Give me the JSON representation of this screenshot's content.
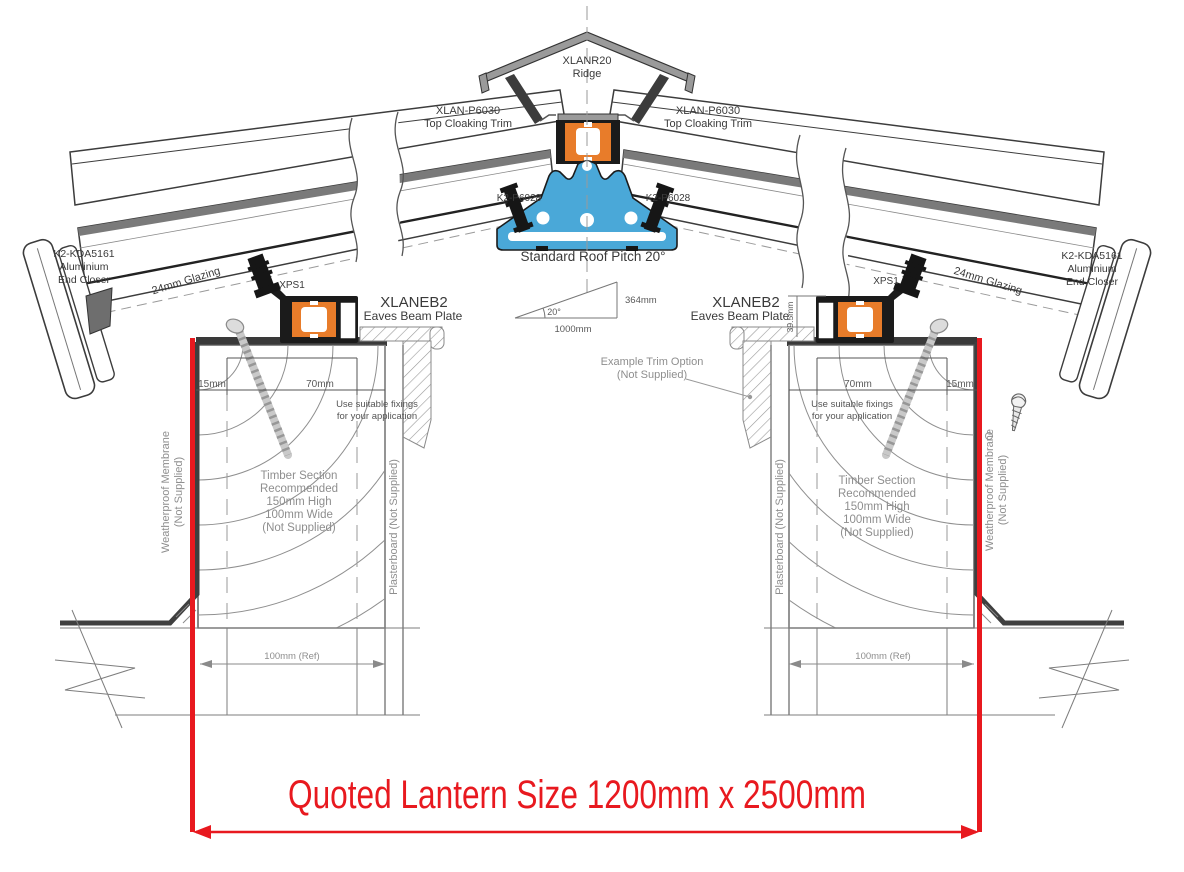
{
  "title": "Roof lantern installation cross-section",
  "colors": {
    "accent_red": "#e8191f",
    "profile_orange": "#e87c2a",
    "profile_blue": "#4aa8d8",
    "steel_gray": "#9a9a9a",
    "ink": "#2b2b2b"
  },
  "ridge": {
    "code": "XLANR20",
    "label": "Ridge"
  },
  "cloaking": {
    "code": "XLAN-P6030",
    "label": "Top Cloaking Trim"
  },
  "rafter_bracket": {
    "code": "K2-P6028"
  },
  "pitch": {
    "caption": "Standard Roof Pitch 20°",
    "angle": "20°",
    "run": "1000mm",
    "rise": "364mm"
  },
  "end_closer": {
    "code": "K2-KDA5161",
    "line2": "Aluminium",
    "line3": "End Closer"
  },
  "glazing_label": "24mm Glazing",
  "xps_label": "XPS1",
  "eaves_beam": {
    "code": "XLANEB2",
    "label": "Eaves Beam Plate"
  },
  "trim_option": {
    "line1": "Example  Trim Option",
    "line2": "(Not Supplied)"
  },
  "dims": {
    "d15": "15mm",
    "d70": "70mm",
    "d39": "39.5mm",
    "ref100": "100mm (Ref)"
  },
  "fixing_note": {
    "line1": "Use suitable fixings",
    "line2": "for your application"
  },
  "timber_note": [
    "Timber Section",
    "Recommended",
    "150mm High",
    "100mm Wide",
    "(Not Supplied)"
  ],
  "membrane_note": {
    "line1": "Weatherproof Membrane",
    "line2": "(Not Supplied)"
  },
  "plasterboard_note": "Plasterboard (Not Supplied)",
  "quote": {
    "text": "Quoted Lantern Size 1200mm x 2500mm"
  }
}
